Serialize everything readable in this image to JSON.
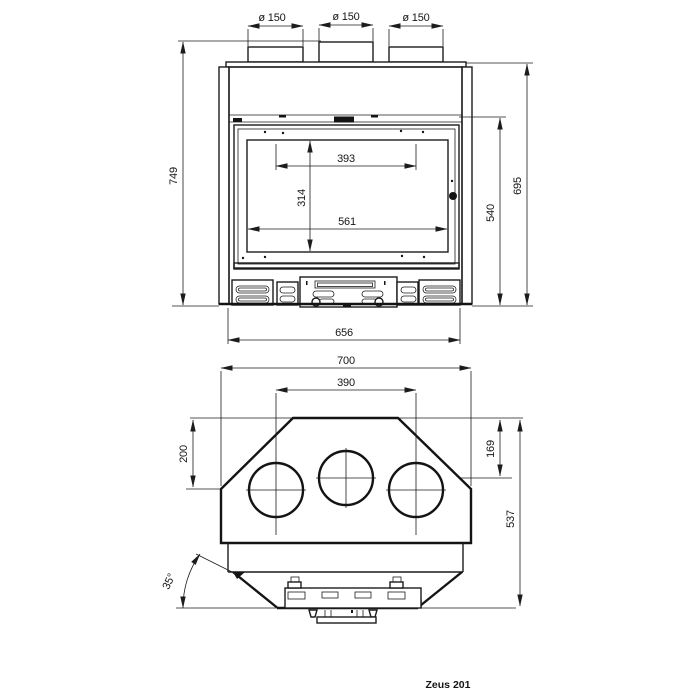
{
  "colors": {
    "ink": "#1c1c1c",
    "background": "#ffffff"
  },
  "front_view": {
    "dims": {
      "flue_diameter_1": "ø 150",
      "flue_diameter_2": "ø 150",
      "flue_diameter_3": "ø 150",
      "overall_height": "749",
      "firebox_opening_width": "393",
      "glass_height": "314",
      "glass_width": "561",
      "insert_height": "540",
      "front_height": "695",
      "body_width": "656"
    }
  },
  "plan_view": {
    "dims": {
      "overall_width": "700",
      "flue_center_distance": "390",
      "left_front_depth": "200",
      "right_front_depth": "169",
      "overall_depth": "537",
      "corner_angle": "35°"
    }
  },
  "footer": {
    "model": "Zeus 201"
  }
}
